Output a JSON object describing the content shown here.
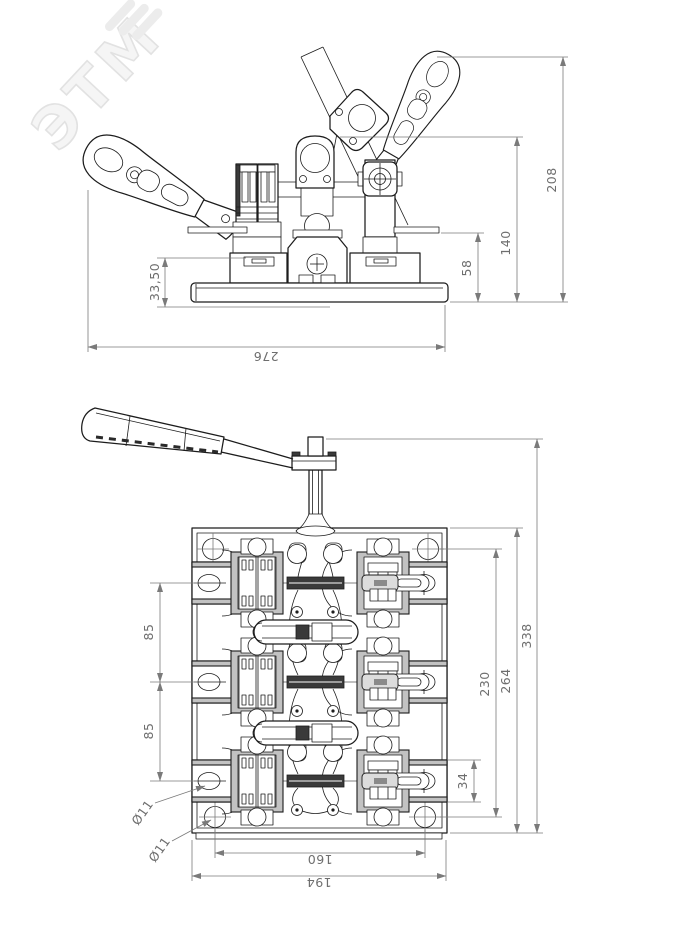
{
  "watermark": {
    "text": "ЭТМ"
  },
  "colors": {
    "object_line": "#1c1c1c",
    "dim_line": "#7a7a7a",
    "dim_text": "#6e6e6e",
    "shade_fill": "#c2c2c2",
    "dark_fill": "#3a3a3a",
    "watermark": "#ececec",
    "background": "#ffffff"
  },
  "side_view": {
    "dims": {
      "base_height": "33,50",
      "flange_height": "58",
      "bracket_height": "140",
      "overall_height": "208",
      "overall_width": "276"
    }
  },
  "plan_view": {
    "dims": {
      "pole_pitch_1": "85",
      "pole_pitch_2": "85",
      "tab_hole_dia": "Ø11",
      "corner_hole_dia": "Ø11",
      "tab_height": "34",
      "hole_span_v": "230",
      "plate_height": "264",
      "overall_height": "338",
      "hole_span_h": "160",
      "plate_width": "194"
    }
  }
}
